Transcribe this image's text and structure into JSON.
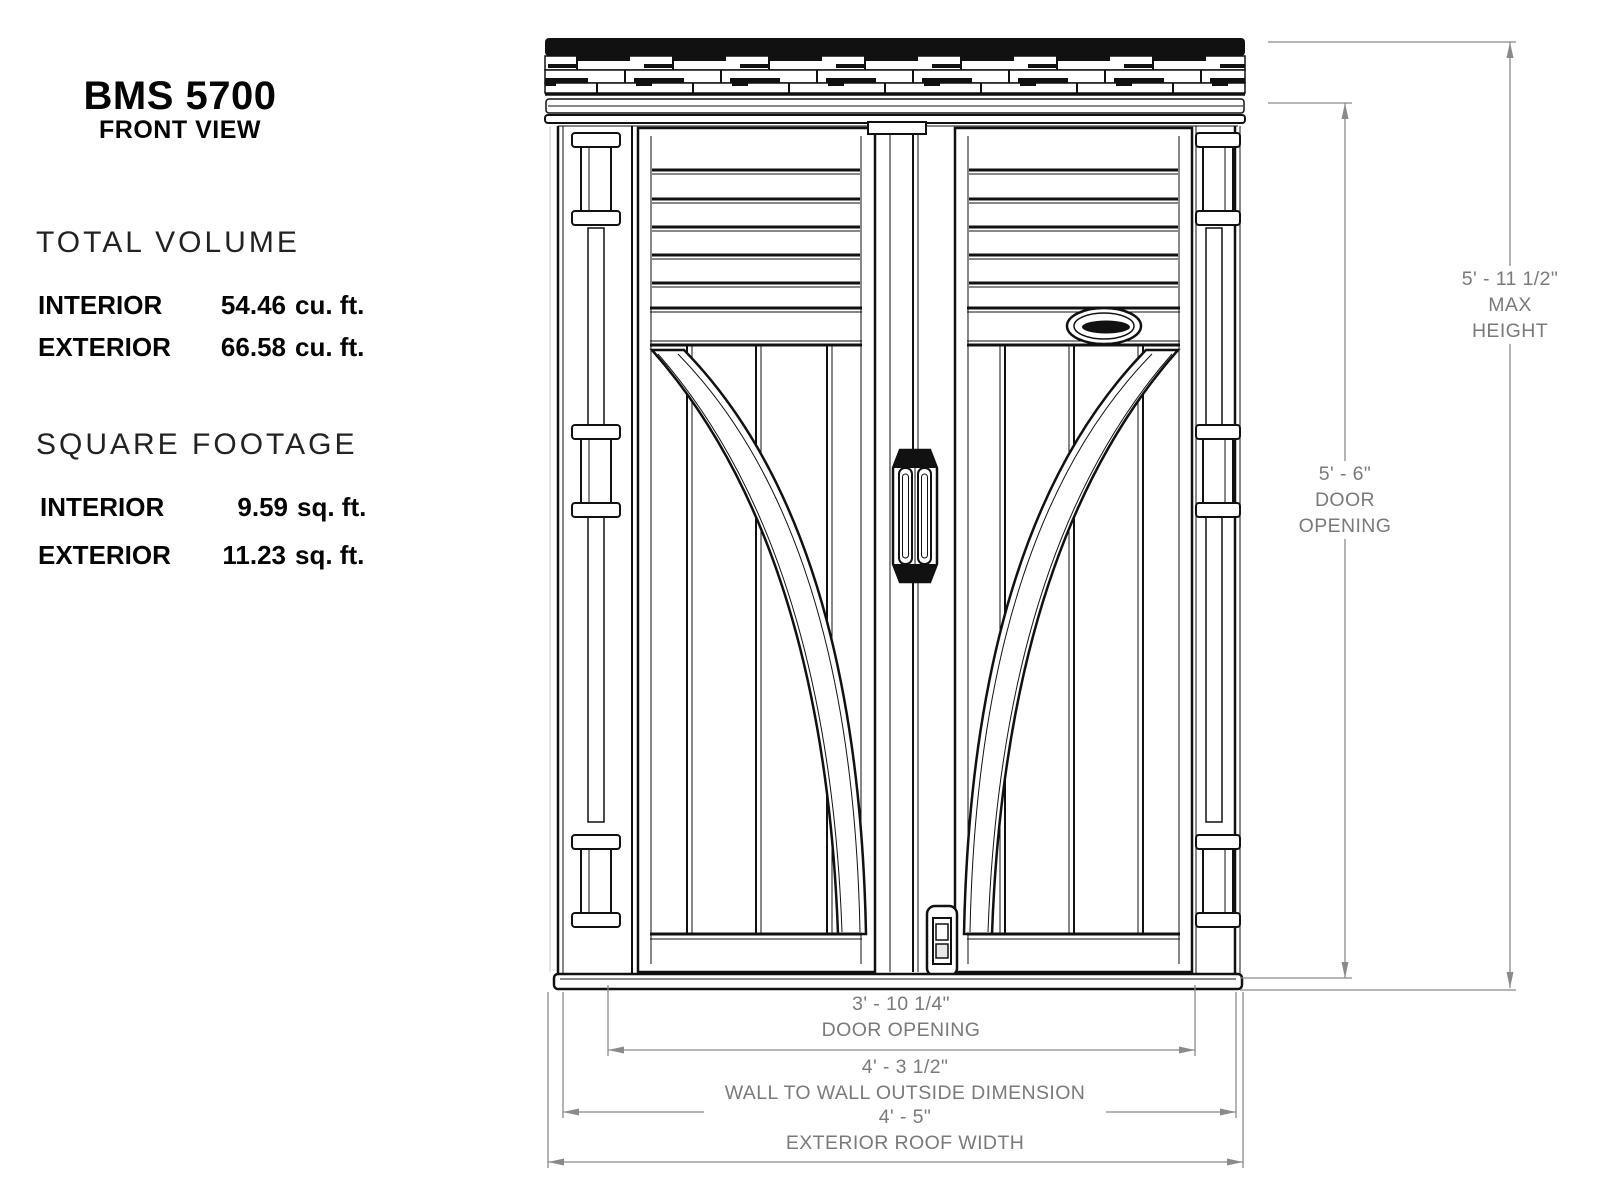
{
  "info": {
    "title": "BMS 5700",
    "subtitle": "FRONT VIEW",
    "sections": [
      {
        "heading": "TOTAL VOLUME",
        "rows": [
          {
            "label": "INTERIOR",
            "number": "54.46",
            "unit": "cu. ft."
          },
          {
            "label": "EXTERIOR",
            "number": "66.58",
            "unit": "cu. ft."
          }
        ]
      },
      {
        "heading": "SQUARE FOOTAGE",
        "rows": [
          {
            "label": "INTERIOR",
            "number": "9.59",
            "unit": "sq. ft."
          },
          {
            "label": "EXTERIOR",
            "number": "11.23",
            "unit": "sq. ft."
          }
        ]
      }
    ]
  },
  "dimensions": {
    "max_height": {
      "value": "5' - 11 1/2\"",
      "label1": "MAX",
      "label2": "HEIGHT"
    },
    "door_opening_height": {
      "value": "5' - 6\"",
      "label1": "DOOR",
      "label2": "OPENING"
    },
    "door_opening_width": {
      "value": "3' - 10 1/4\"",
      "label": "DOOR OPENING"
    },
    "wall_to_wall": {
      "value": "4' - 3 1/2\"",
      "label": "WALL TO WALL OUTSIDE DIMENSION"
    },
    "roof_width": {
      "value": "4' - 5\"",
      "label": "EXTERIOR ROOF WIDTH"
    }
  },
  "icons": {
    "logo": "suncast-oval-logo"
  },
  "colors": {
    "line": "#111111",
    "dimension": "#8a8a8a",
    "background": "#ffffff"
  }
}
